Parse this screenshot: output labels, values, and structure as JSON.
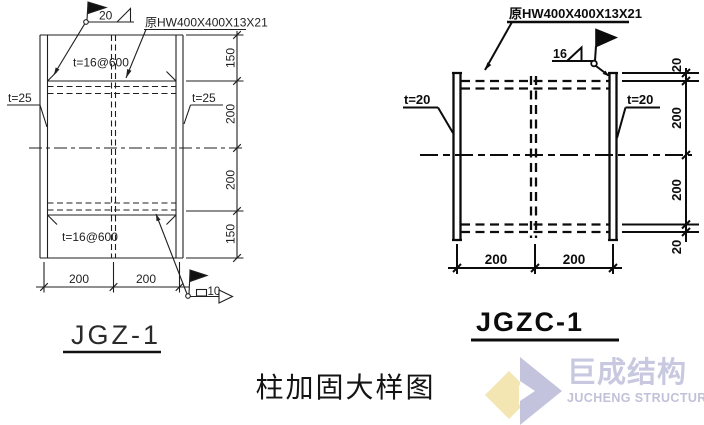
{
  "title": "柱加固大样图",
  "left_diagram": {
    "name": "JGZ-1",
    "section_label": "原HW400X400X13X21",
    "flange_thickness_left": "t=25",
    "flange_thickness_right": "t=25",
    "stiffener_top": "t=16@600",
    "stiffener_bottom": "t=16@600",
    "weld_top": "20",
    "weld_bottom": "10",
    "dims_right": [
      "150",
      "200",
      "200",
      "150"
    ],
    "dims_bottom": [
      "200",
      "200"
    ]
  },
  "right_diagram": {
    "name": "JGZC-1",
    "section_label": "原HW400X400X13X21",
    "plate_thickness_left": "t=20",
    "plate_thickness_right": "t=20",
    "weld_top": "16",
    "dims_right": [
      "20",
      "200",
      "200",
      "20"
    ],
    "dims_bottom": [
      "200",
      "200"
    ]
  },
  "logo": {
    "zh": "巨成结构",
    "en": "JUCHENG STRUCTURE",
    "colors": {
      "lavender": "#c3c3de",
      "yellow": "#f4e6b2"
    }
  }
}
